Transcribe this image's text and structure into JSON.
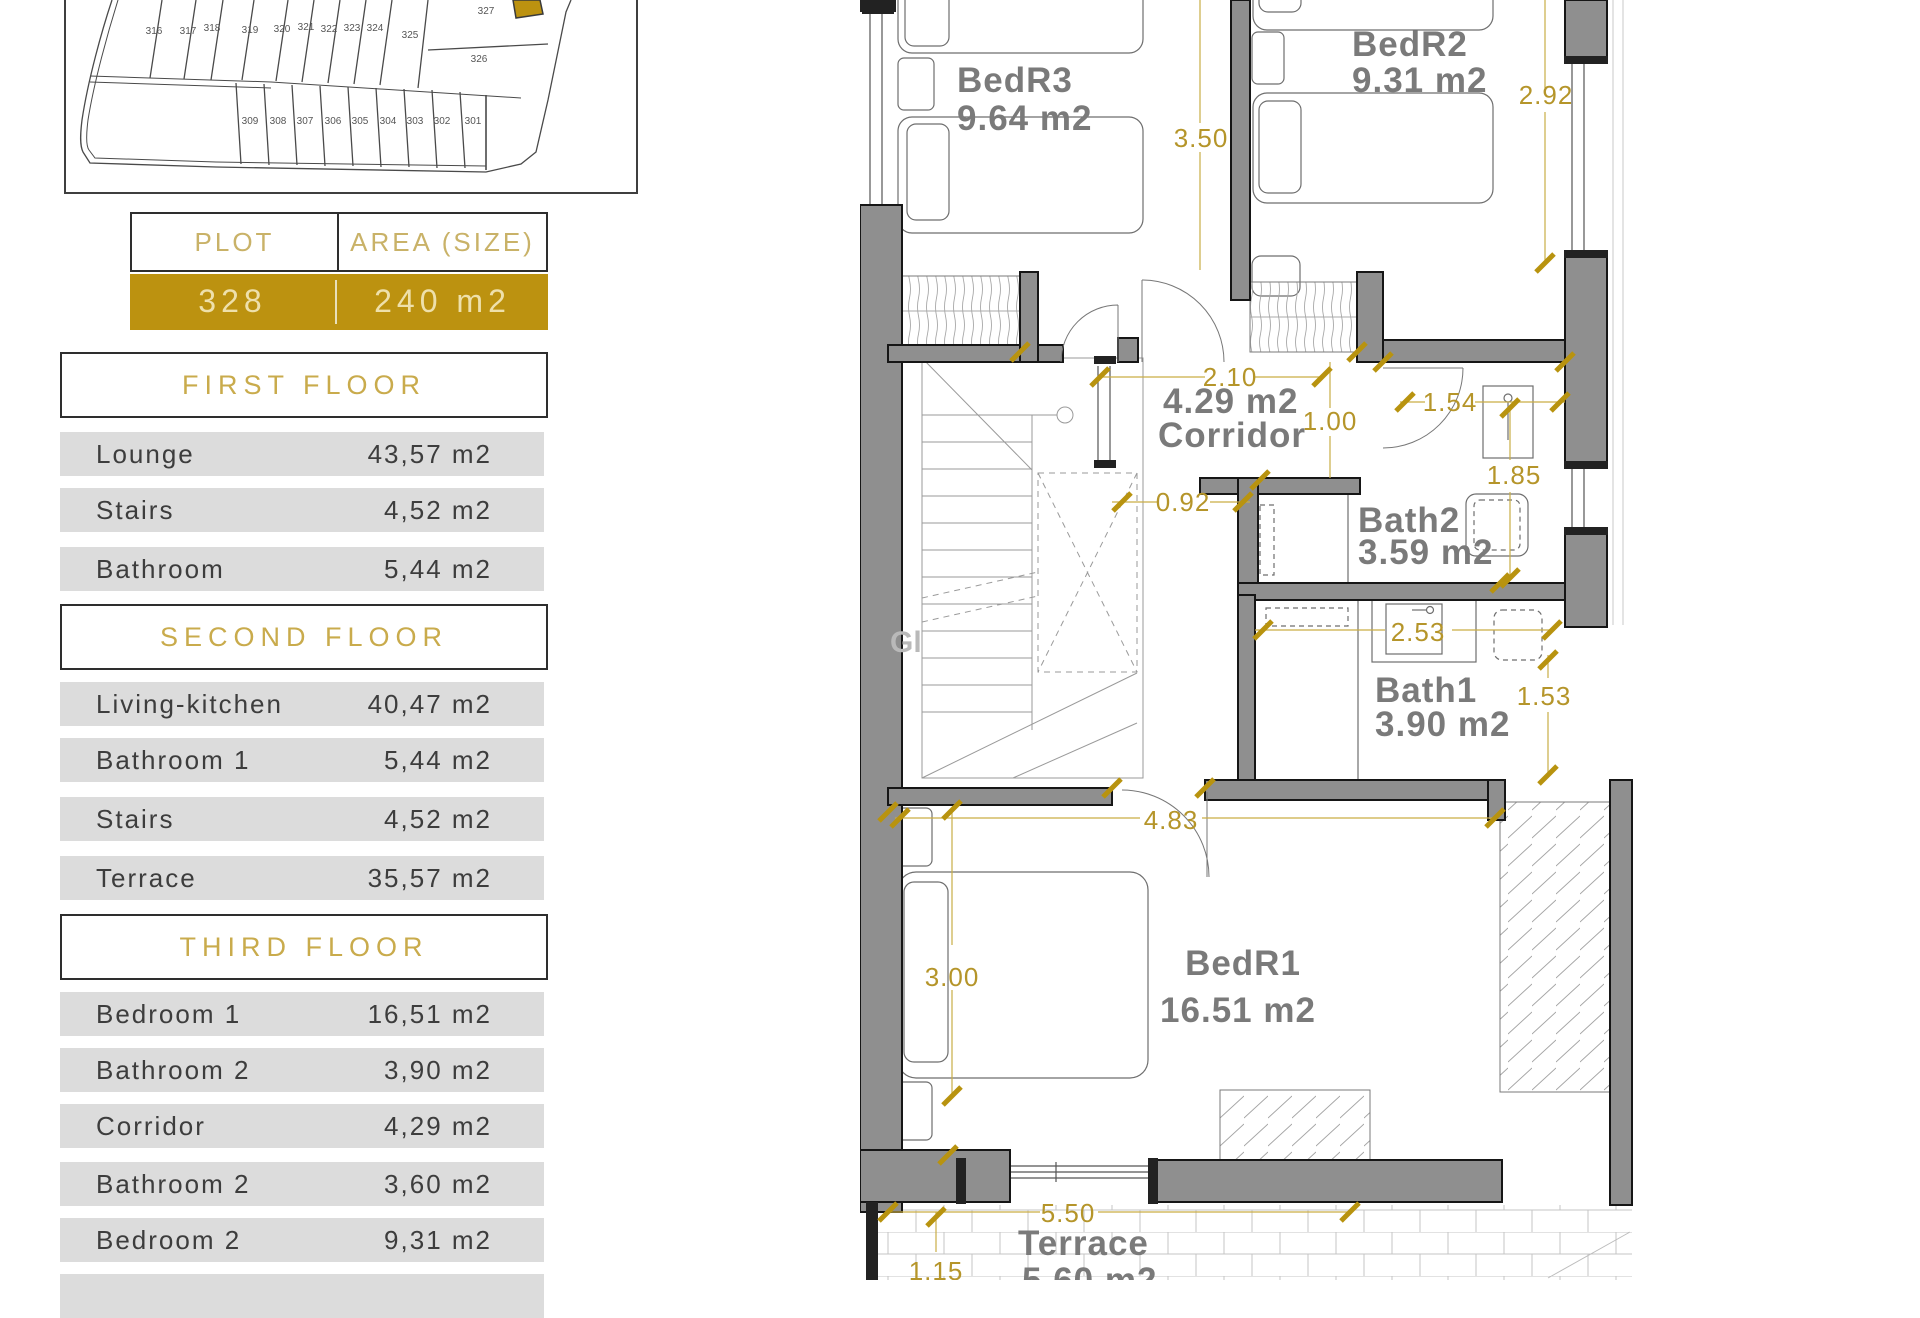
{
  "colors": {
    "accent_gold": "#bc9210",
    "dimension_gold": "#b5952a",
    "row_gray": "#dcdcdc",
    "wall_gray": "#8f8f8f"
  },
  "plot_map": {
    "top_row": [
      "316",
      "317",
      "318",
      "319",
      "320",
      "321",
      "322",
      "323",
      "324",
      "325"
    ],
    "plot_327": "327",
    "plot_326": "326",
    "bottom_row": [
      "309",
      "308",
      "307",
      "306",
      "305",
      "304",
      "303",
      "302",
      "301"
    ]
  },
  "plot_table": {
    "plot_header": "PLOT",
    "area_header": "AREA (SIZE)",
    "plot_value": "328",
    "area_value": "240 m2"
  },
  "sections": [
    {
      "title": "FIRST FLOOR",
      "rows": [
        {
          "label": "Lounge",
          "value": "43,57 m2"
        },
        {
          "label": "Stairs",
          "value": "4,52 m2"
        },
        {
          "label": "Bathroom",
          "value": "5,44 m2"
        }
      ]
    },
    {
      "title": "SECOND FLOOR",
      "rows": [
        {
          "label": "Living-kitchen",
          "value": "40,47 m2"
        },
        {
          "label": "Bathroom 1",
          "value": "5,44 m2"
        },
        {
          "label": "Stairs",
          "value": "4,52 m2"
        },
        {
          "label": "Terrace",
          "value": "35,57 m2"
        }
      ]
    },
    {
      "title": "THIRD FLOOR",
      "rows": [
        {
          "label": "Bedroom 1",
          "value": "16,51 m2"
        },
        {
          "label": "Bathroom 2",
          "value": "3,90 m2"
        },
        {
          "label": "Corridor",
          "value": "4,29 m2"
        },
        {
          "label": "Bathroom 2",
          "value": "3,60 m2"
        },
        {
          "label": "Bedroom 2",
          "value": "9,31 m2"
        }
      ]
    }
  ],
  "floor_plan": {
    "rooms": {
      "bedr3": {
        "name": "BedR3",
        "area": "9.64 m2"
      },
      "bedr2": {
        "name": "BedR2",
        "area": "9.31 m2"
      },
      "corridor": {
        "area": "4.29 m2",
        "name": "Corridor"
      },
      "bath2": {
        "name": "Bath2",
        "area": "3.59 m2"
      },
      "bath1": {
        "name": "Bath1",
        "area": "3.90 m2"
      },
      "bedr1": {
        "name": "BedR1",
        "area": "16.51 m2"
      },
      "terrace": {
        "name": "Terrace",
        "area": "5.60 m2"
      }
    },
    "dims": {
      "bedr3_height": "3.50",
      "bedr2_height": "2.92",
      "corridor_width": "2.10",
      "hall_width": "1.00",
      "nook_width": "1.54",
      "bath2_height": "1.85",
      "passage_width": "0.92",
      "bath1_width": "2.53",
      "bath1_height": "1.53",
      "bedr1_width": "4.83",
      "bedr1_height": "3.00",
      "terrace_width": "5.50",
      "terrace_side": "1.15"
    },
    "watermark": "Gl"
  }
}
